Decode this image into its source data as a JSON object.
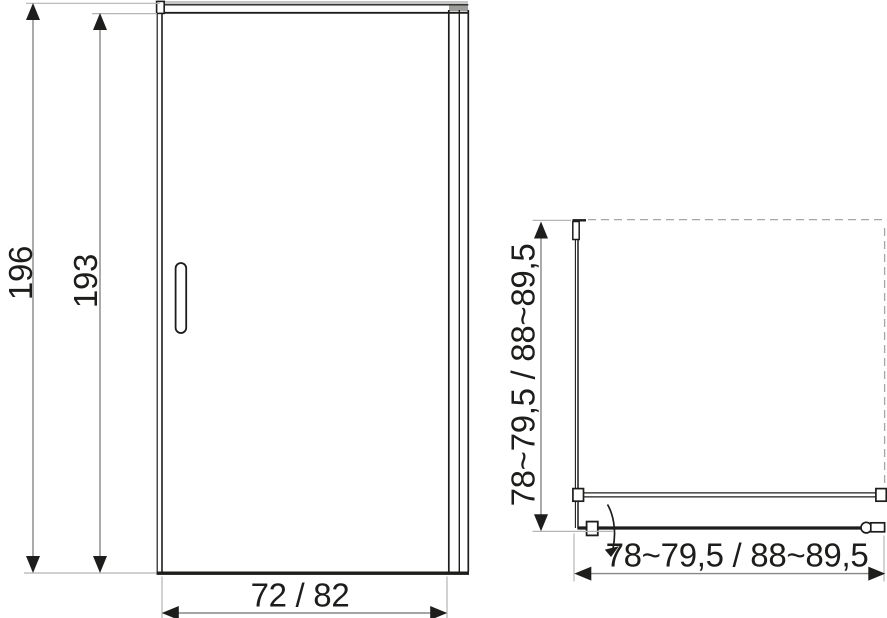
{
  "front_view": {
    "dim_total_height": "196",
    "dim_glass_height": "193",
    "dim_width": "72 / 82"
  },
  "top_view": {
    "dim_depth": "78~79,5 / 88~89,5",
    "dim_width": "78~79,5 / 88~89,5"
  },
  "colors": {
    "line": "#1d1d1b",
    "dimension_line": "#878787",
    "extension_line": "#b5b5b5",
    "dashed_wall_line": "#a6a6a6",
    "frame_fill_light": "#c6c6c6",
    "frame_fill_mid": "#9d9d9c",
    "background": "#ffffff"
  }
}
